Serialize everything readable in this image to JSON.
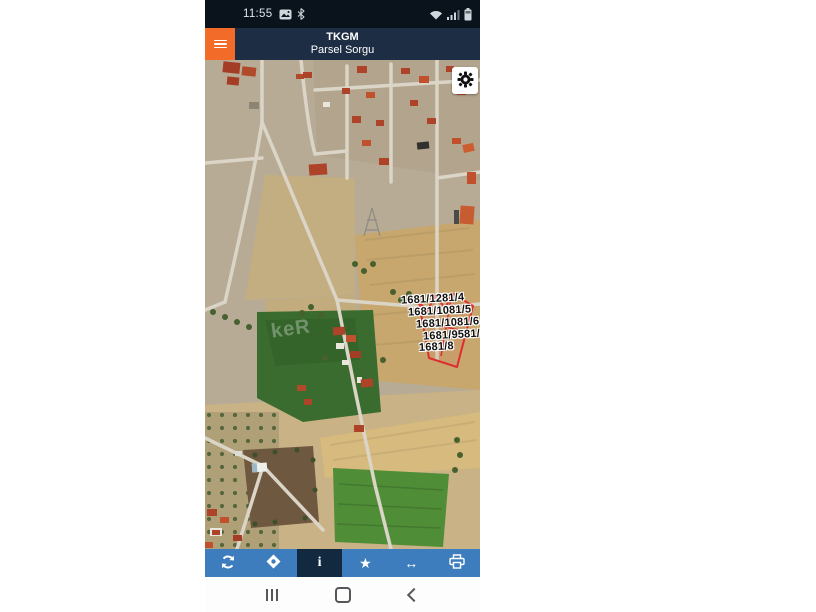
{
  "status_bar": {
    "time": "11:55",
    "icons_left": [
      "screenshot-icon",
      "bluetooth-icon"
    ],
    "icons_right": [
      "wifi-icon",
      "signal-icon",
      "battery-icon"
    ]
  },
  "header": {
    "title": "TKGM",
    "subtitle": "Parsel Sorgu",
    "menu_icon": "hamburger-icon"
  },
  "map": {
    "type": "satellite-parcel-map",
    "settings_icon": "gear-icon",
    "watermark": "keR",
    "parcel_labels": [
      {
        "text": "1681/1281/4"
      },
      {
        "text": "1681/1081/5"
      },
      {
        "text": "1681/1081/6"
      },
      {
        "text": "1681/9581/7"
      },
      {
        "text": "1681/8"
      }
    ],
    "highlight_color": "#dc2f2f"
  },
  "toolbar": {
    "buttons": [
      {
        "name": "refresh",
        "icon": "refresh-icon"
      },
      {
        "name": "locate",
        "icon": "locate-diamond-icon"
      },
      {
        "name": "info",
        "glyph": "i",
        "active": true
      },
      {
        "name": "favorite",
        "glyph": "★"
      },
      {
        "name": "pan-horizontal",
        "glyph": "↔"
      },
      {
        "name": "print",
        "icon": "printer-icon"
      }
    ]
  },
  "nav_bar": {
    "buttons": [
      "recents",
      "home",
      "back"
    ]
  },
  "colors": {
    "accent_orange": "#f26b29",
    "header_navy": "#1d2d44",
    "toolbar_blue": "#3d7dbd",
    "toolbar_active": "#13293f",
    "status_black": "#0a131c",
    "parcel_red": "#dc2f2f"
  }
}
